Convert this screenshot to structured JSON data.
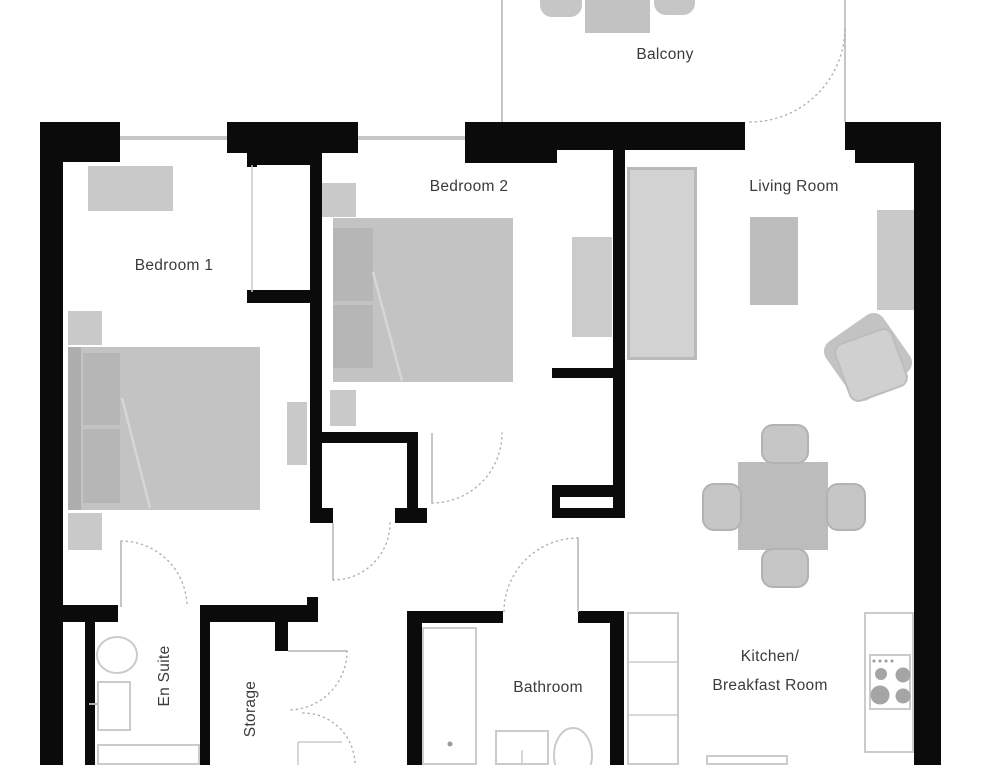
{
  "rooms": {
    "bedroom1": {
      "label": "Bedroom 1"
    },
    "bedroom2": {
      "label": "Bedroom 2"
    },
    "living": {
      "label": "Living Room"
    },
    "balcony": {
      "label": "Balcony"
    },
    "ensuite": {
      "label": "En Suite"
    },
    "storage": {
      "label": "Storage"
    },
    "bathroom": {
      "label": "Bathroom"
    },
    "kitchen": {
      "line1": "Kitchen/",
      "line2": "Breakfast Room"
    }
  },
  "colors": {
    "wall": "#0b0b0b",
    "text": "#3b3b3b",
    "furniture": "#c9c9c9",
    "furniture_dark": "#b6b6b6",
    "outline": "#cbcbcb",
    "door_arc": "#b0b0b0",
    "door_leaf": "#c6c6c6"
  },
  "plan": {
    "walls": [
      [
        "outer-left",
        40,
        122,
        23,
        643
      ],
      [
        "pillar-top-left",
        40,
        122,
        80,
        40
      ],
      [
        "top-bedroom1",
        227,
        122,
        131,
        31
      ],
      [
        "top-bedroom1-lip",
        247,
        153,
        66,
        12
      ],
      [
        "top-bedroom2",
        465,
        122,
        280,
        28
      ],
      [
        "top-bedroom2-lip",
        465,
        150,
        92,
        13
      ],
      [
        "top-right",
        845,
        122,
        96,
        28
      ],
      [
        "pillar-top-right",
        855,
        122,
        86,
        41
      ],
      [
        "outer-right",
        914,
        122,
        27,
        643
      ],
      [
        "niche-stub",
        247,
        152,
        10,
        15
      ],
      [
        "niche-bottom",
        247,
        290,
        66,
        13
      ],
      [
        "divider-bedroom1-bedroom2",
        310,
        150,
        12,
        373
      ],
      [
        "divider-bedroom1-foot",
        310,
        508,
        23,
        15
      ],
      [
        "closet-top",
        318,
        432,
        100,
        11
      ],
      [
        "closet-right",
        407,
        443,
        11,
        80
      ],
      [
        "closet-foot",
        395,
        508,
        32,
        15
      ],
      [
        "bedroom2-closet-stub",
        552,
        368,
        61,
        10
      ],
      [
        "bedroom2-closet-mid",
        552,
        485,
        73,
        12
      ],
      [
        "bedroom2-closet-left",
        552,
        497,
        8,
        21
      ],
      [
        "bedroom2-closet-bottom",
        560,
        508,
        65,
        10
      ],
      [
        "divider-bedroom2-living",
        613,
        148,
        12,
        370
      ],
      [
        "hall-south-west",
        63,
        605,
        55,
        17
      ],
      [
        "hall-south-east",
        200,
        605,
        118,
        17
      ],
      [
        "hall-south-cap",
        307,
        597,
        11,
        8
      ],
      [
        "ensuite-shaft",
        85,
        622,
        10,
        143
      ],
      [
        "ensuite-east",
        200,
        622,
        10,
        143
      ],
      [
        "storage-east-stub",
        275,
        622,
        13,
        29
      ],
      [
        "bathroom-top-west",
        407,
        611,
        96,
        12
      ],
      [
        "bathroom-top-east",
        578,
        611,
        42,
        12
      ],
      [
        "bathroom-west",
        407,
        611,
        15,
        154
      ],
      [
        "bathroom-east",
        610,
        611,
        14,
        154
      ]
    ],
    "windows": [
      [
        "window-bedroom1",
        120,
        136,
        107,
        4
      ],
      [
        "window-bedroom2",
        358,
        136,
        107,
        4
      ]
    ],
    "balcony_lines": [
      [
        "balcony-edge-west",
        501,
        0,
        2,
        122
      ],
      [
        "balcony-edge-east",
        844,
        0,
        2,
        48
      ]
    ],
    "furniture_solid": [
      {
        "n": "bedroom1-dresser",
        "x": 88,
        "y": 166,
        "w": 85,
        "h": 45,
        "f": "#c9c9c9"
      },
      {
        "n": "bedroom1-nightstand-top",
        "x": 68,
        "y": 311,
        "w": 34,
        "h": 34,
        "f": "#c9c9c9"
      },
      {
        "n": "bedroom1-bed",
        "x": 68,
        "y": 347,
        "w": 192,
        "h": 163,
        "f": "#c3c3c3"
      },
      {
        "n": "bedroom1-bed-headboard",
        "x": 68,
        "y": 347,
        "w": 13,
        "h": 163,
        "f": "#aeaeae"
      },
      {
        "n": "bedroom1-pillow-1",
        "x": 83,
        "y": 353,
        "w": 37,
        "h": 72,
        "f": "#b6b6b6"
      },
      {
        "n": "bedroom1-pillow-2",
        "x": 83,
        "y": 429,
        "w": 37,
        "h": 74,
        "f": "#b6b6b6"
      },
      {
        "n": "bedroom1-nightstand-bottom",
        "x": 68,
        "y": 513,
        "w": 34,
        "h": 37,
        "f": "#c9c9c9"
      },
      {
        "n": "bedroom1-side-table",
        "x": 287,
        "y": 402,
        "w": 20,
        "h": 63,
        "f": "#c9c9c9"
      },
      {
        "n": "bedroom2-nightstand",
        "x": 322,
        "y": 183,
        "w": 34,
        "h": 34,
        "f": "#c9c9c9"
      },
      {
        "n": "bedroom2-bed",
        "x": 333,
        "y": 218,
        "w": 180,
        "h": 164,
        "f": "#c3c3c3"
      },
      {
        "n": "bedroom2-pillow-1",
        "x": 333,
        "y": 228,
        "w": 40,
        "h": 73,
        "f": "#b6b6b6"
      },
      {
        "n": "bedroom2-pillow-2",
        "x": 333,
        "y": 305,
        "w": 40,
        "h": 63,
        "f": "#b6b6b6"
      },
      {
        "n": "bedroom2-dresser",
        "x": 572,
        "y": 237,
        "w": 40,
        "h": 100,
        "f": "#cbcbcb"
      },
      {
        "n": "bedroom2-nightstand-2",
        "x": 330,
        "y": 390,
        "w": 26,
        "h": 36,
        "f": "#c9c9c9"
      },
      {
        "n": "living-sofa",
        "x": 627,
        "y": 167,
        "w": 70,
        "h": 193,
        "f": "#d2d2d2",
        "b": "#b9b9b9",
        "bw": 3
      },
      {
        "n": "living-coffee-table",
        "x": 750,
        "y": 217,
        "w": 48,
        "h": 88,
        "f": "#bdbdbd"
      },
      {
        "n": "living-tv-unit",
        "x": 877,
        "y": 210,
        "w": 37,
        "h": 100,
        "f": "#c9c9c9"
      },
      {
        "n": "living-armchair-back",
        "x": 833,
        "y": 322,
        "w": 70,
        "h": 70,
        "f": "#c3c3c3",
        "r": "12px",
        "rot": -35
      },
      {
        "n": "living-armchair-seat",
        "x": 840,
        "y": 334,
        "w": 62,
        "h": 62,
        "f": "#d0d0d0",
        "b": "#bdbdbd",
        "bw": 2,
        "r": "10px",
        "rot": -20
      },
      {
        "n": "dining-table",
        "x": 738,
        "y": 462,
        "w": 90,
        "h": 88,
        "f": "#bcbcbc"
      },
      {
        "n": "dining-chair-north",
        "x": 761,
        "y": 424,
        "w": 48,
        "h": 40,
        "f": "#c6c6c6",
        "b": "#b2b2b2",
        "bw": 2,
        "r": "12px"
      },
      {
        "n": "dining-chair-south",
        "x": 761,
        "y": 548,
        "w": 48,
        "h": 40,
        "f": "#c6c6c6",
        "b": "#b2b2b2",
        "bw": 2,
        "r": "12px"
      },
      {
        "n": "dining-chair-west",
        "x": 702,
        "y": 483,
        "w": 40,
        "h": 48,
        "f": "#c6c6c6",
        "b": "#b2b2b2",
        "bw": 2,
        "r": "12px"
      },
      {
        "n": "dining-chair-east",
        "x": 826,
        "y": 483,
        "w": 40,
        "h": 48,
        "f": "#c6c6c6",
        "b": "#b2b2b2",
        "bw": 2,
        "r": "12px"
      },
      {
        "n": "balcony-table",
        "x": 585,
        "y": 0,
        "w": 65,
        "h": 33,
        "f": "#c2c2c2"
      },
      {
        "n": "balcony-chair-left",
        "x": 540,
        "y": 0,
        "w": 42,
        "h": 17,
        "f": "#c6c6c6",
        "r": "0 0 12px 12px"
      },
      {
        "n": "balcony-chair-right",
        "x": 654,
        "y": 0,
        "w": 41,
        "h": 15,
        "f": "#c6c6c6",
        "r": "0 0 12px 12px"
      }
    ],
    "furniture_outline": [
      {
        "n": "kitchen-counter",
        "x": 627,
        "y": 612,
        "w": 52,
        "h": 153
      },
      {
        "n": "kitchen-sink",
        "x": 706,
        "y": 755,
        "w": 82,
        "h": 10
      },
      {
        "n": "stove",
        "x": 864,
        "y": 612,
        "w": 50,
        "h": 141
      },
      {
        "n": "stove-burner-panel",
        "x": 869,
        "y": 654,
        "w": 42,
        "h": 56
      },
      {
        "n": "bathtub",
        "x": 422,
        "y": 627,
        "w": 55,
        "h": 138
      },
      {
        "n": "bathroom-sink",
        "x": 495,
        "y": 730,
        "w": 54,
        "h": 35
      },
      {
        "n": "ensuite-sink",
        "x": 97,
        "y": 681,
        "w": 34,
        "h": 50
      },
      {
        "n": "ensuite-shower",
        "x": 97,
        "y": 744,
        "w": 103,
        "h": 21
      }
    ],
    "ellipses": [
      {
        "n": "ensuite-toilet",
        "cx": 117,
        "cy": 655,
        "rx": 20,
        "ry": 18
      },
      {
        "n": "bathroom-toilet",
        "cx": 573,
        "cy": 755,
        "rx": 19,
        "ry": 27
      }
    ],
    "circles": [
      {
        "n": "stove-burner-1",
        "cx": 881,
        "cy": 674,
        "r": 6,
        "f": "#a5a5a5"
      },
      {
        "n": "stove-burner-2",
        "cx": 903,
        "cy": 675,
        "r": 7.5,
        "f": "#a5a5a5"
      },
      {
        "n": "stove-burner-3",
        "cx": 880,
        "cy": 695,
        "r": 9.5,
        "f": "#a5a5a5"
      },
      {
        "n": "stove-burner-4",
        "cx": 903,
        "cy": 696,
        "r": 7.5,
        "f": "#a5a5a5"
      },
      {
        "n": "stove-knob-1",
        "cx": 874,
        "cy": 661,
        "r": 1.5,
        "f": "#999999"
      },
      {
        "n": "stove-knob-2",
        "cx": 880,
        "cy": 661,
        "r": 1.5,
        "f": "#999999"
      },
      {
        "n": "stove-knob-3",
        "cx": 886,
        "cy": 661,
        "r": 1.5,
        "f": "#999999"
      },
      {
        "n": "stove-knob-4",
        "cx": 892,
        "cy": 661,
        "r": 1.5,
        "f": "#999999"
      },
      {
        "n": "bathtub-drain",
        "cx": 450,
        "cy": 744,
        "r": 2.5,
        "f": "#999999"
      }
    ],
    "lines": [
      {
        "n": "counter-divider-1",
        "x1": 627,
        "y1": 662,
        "x2": 679,
        "y2": 662,
        "c": "#cbcbcb",
        "w": 1.5
      },
      {
        "n": "counter-divider-2",
        "x1": 627,
        "y1": 715,
        "x2": 679,
        "y2": 715,
        "c": "#cbcbcb",
        "w": 1.5
      },
      {
        "n": "ensuite-tap",
        "x1": 89,
        "y1": 704,
        "x2": 97,
        "y2": 704,
        "c": "#adadad",
        "w": 2
      },
      {
        "n": "bed1-fold",
        "x1": 122,
        "y1": 398,
        "x2": 150,
        "y2": 508,
        "c": "#d6d6d6",
        "w": 2.5
      },
      {
        "n": "bed2-fold",
        "x1": 373,
        "y1": 272,
        "x2": 402,
        "y2": 381,
        "c": "#d6d6d6",
        "w": 2.5
      },
      {
        "n": "niche-edge",
        "x1": 252,
        "y1": 165,
        "x2": 252,
        "y2": 292,
        "c": "#cbcbcb",
        "w": 1.5
      },
      {
        "n": "bathroom-sink-tap",
        "x1": 522,
        "y1": 750,
        "x2": 522,
        "y2": 764,
        "c": "#cbcbcb",
        "w": 1.5
      },
      {
        "n": "entry-frame-h",
        "x1": 298,
        "y1": 742,
        "x2": 342,
        "y2": 742,
        "c": "#cbcbcb",
        "w": 1.5
      },
      {
        "n": "entry-frame-v",
        "x1": 298,
        "y1": 742,
        "x2": 298,
        "y2": 765,
        "c": "#cbcbcb",
        "w": 1.5
      }
    ],
    "doors": [
      {
        "n": "balcony-door",
        "leaf": [
          845,
          27,
          845,
          122
        ],
        "arc": "M 750 122 A 95 95 0 0 0 845 27"
      },
      {
        "n": "bedroom1-ensuite-door",
        "leaf": [
          121,
          541,
          121,
          607
        ],
        "arc": "M 121 541 A 66 66 0 0 1 187 607"
      },
      {
        "n": "bedroom1-hall-door",
        "leaf": [
          333,
          523,
          333,
          580
        ],
        "arc": "M 333 580 A 57 57 0 0 0 390 523"
      },
      {
        "n": "bedroom2-door",
        "leaf": [
          432,
          433,
          432,
          503
        ],
        "arc": "M 432 503 A 70 70 0 0 0 502 433"
      },
      {
        "n": "bathroom-door",
        "leaf": [
          578,
          538,
          578,
          612
        ],
        "arc": "M 578 538 A 74 74 0 0 0 504 612"
      },
      {
        "n": "storage-door",
        "leaf": [
          288,
          651,
          347,
          651
        ],
        "arc": "M 347 651 A 59 59 0 0 1 288 710"
      },
      {
        "n": "entry-door",
        "leaf": null,
        "arc": "M 303 713 A 52 52 0 0 1 355 765"
      }
    ]
  }
}
